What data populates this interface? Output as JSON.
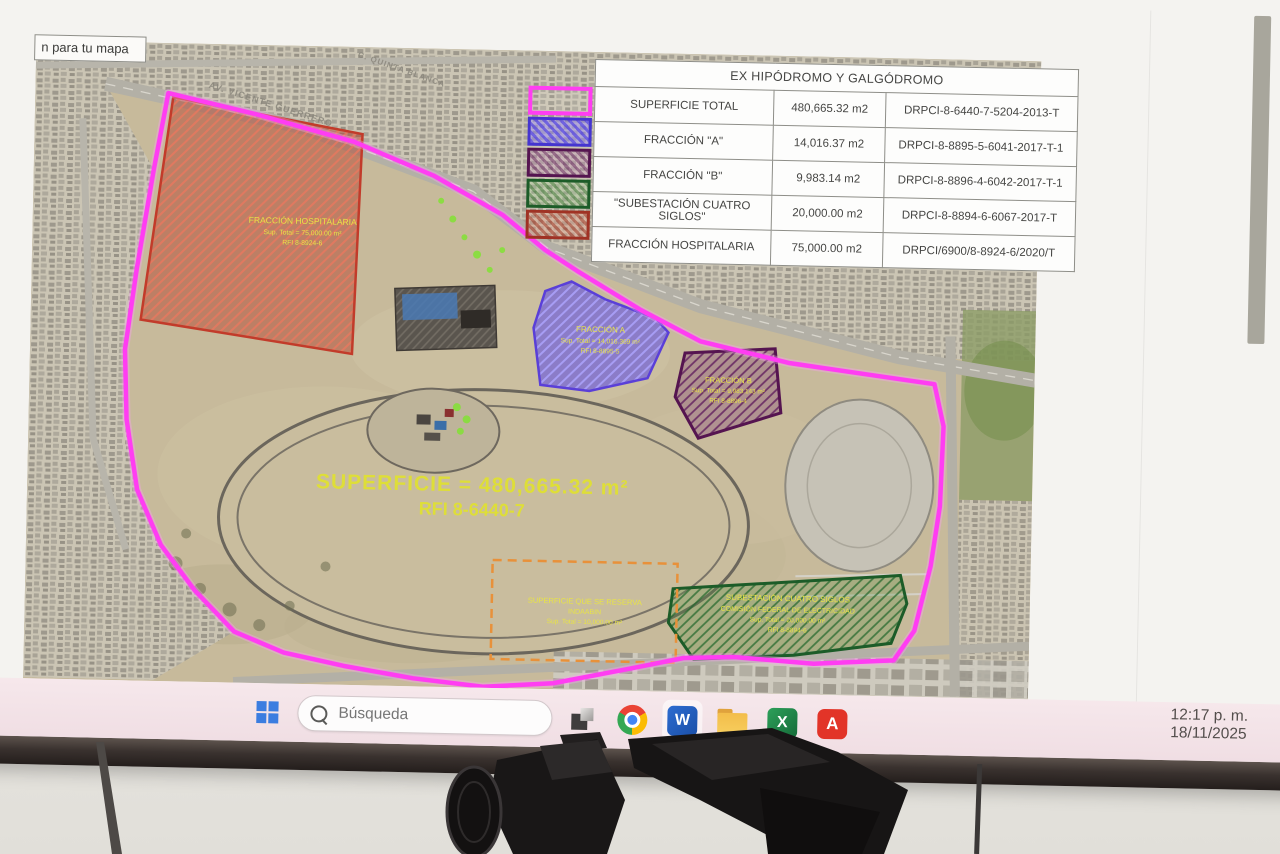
{
  "screen": {
    "tooltip": "n para tu mapa",
    "clock_time": "12:17 p. m.",
    "clock_date": "18/11/2025"
  },
  "taskbar": {
    "search_placeholder": "Búsqueda",
    "icons": [
      "windows",
      "search",
      "task-view",
      "chrome",
      "word",
      "file-explorer",
      "excel",
      "acrobat"
    ]
  },
  "table": {
    "title": "EX HIPÓDROMO Y GALGÓDROMO",
    "rows": [
      {
        "name": "SUPERFICIE TOTAL",
        "area": "480,665.32 m2",
        "id": "DRPCI-8-6440-7-5204-2013-T",
        "swatch": "magenta-outline"
      },
      {
        "name": "FRACCIÓN \"A\"",
        "area": "14,016.37 m2",
        "id": "DRPCI-8-8895-5-6041-2017-T-1",
        "swatch": "blue-hatch"
      },
      {
        "name": "FRACCIÓN \"B\"",
        "area": "9,983.14 m2",
        "id": "DRPCI-8-8896-4-6042-2017-T-1",
        "swatch": "purple-hatch"
      },
      {
        "name": "\"SUBESTACIÓN CUATRO SIGLOS\"",
        "area": "20,000.00 m2",
        "id": "DRPCI-8-8894-6-6067-2017-T",
        "swatch": "green-hatch"
      },
      {
        "name": "FRACCIÓN HOSPITALARIA",
        "area": "75,000.00 m2",
        "id": "DRPCI/6900/8-8924-6/2020/T",
        "swatch": "red-hatch"
      }
    ]
  },
  "map": {
    "hosp": {
      "l1": "FRACCIÓN HOSPITALARIA",
      "l2": "Sup. Total = 75,000.00 m²",
      "l3": "RFI 8-8924-6"
    },
    "fa": {
      "l1": "FRACCIÓN A",
      "l2": "Sup. Total = 14,016.369 m²",
      "l3": "RFI 8-8895-5"
    },
    "fb": {
      "l1": "FRACCIÓN B",
      "l2": "Sup. Total = 9,983.143 m²",
      "l3": "RFI 8-8896-4"
    },
    "sub": {
      "l1": "SUBESTACIÓN CUATRO SIGLOS",
      "l2": "COMISIÓN FEDERAL DE ELECTRICIDAD",
      "l3": "Sup. Total = 20,000.00 m²",
      "l4": "RFI 8-8894-6"
    },
    "res": {
      "l1": "SUPERFICIE QUE SE RESERVA",
      "l2": "INDAABIN",
      "l3": "Sup. Total = 10,000.00 m²"
    },
    "total": {
      "l1": "SUPERFICIE = 480,665.32 m²",
      "l2": "RFI 8-6440-7"
    },
    "streets": {
      "s1": "AV. VICENTE GUERRERO",
      "s2": "C. QUINTA BLANCA"
    }
  },
  "colors": {
    "boundary_magenta": "#ff3df2",
    "hospitalaria_red": "#a03224",
    "fraccion_a_blue": "#4535d0",
    "fraccion_b_purple": "#551450",
    "subestacion_green": "#1c5c28",
    "reserva_orange": "#e8913a",
    "label_yellow": "#e8e446",
    "taskbar_tint": "#f2dee3"
  }
}
